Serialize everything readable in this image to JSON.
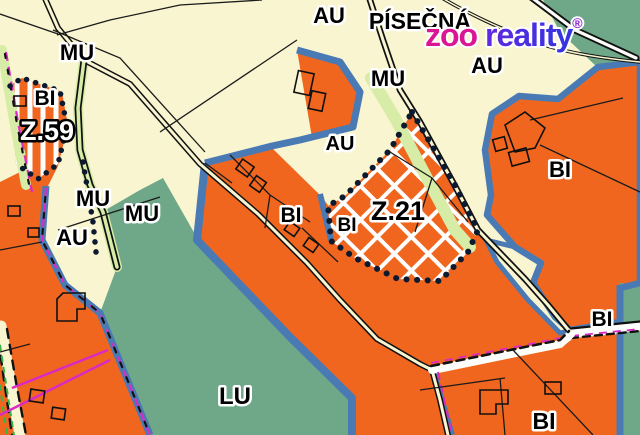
{
  "map": {
    "place_name": "PÍSEČNÁ",
    "zone_codes": {
      "mu": "MU",
      "au": "AU",
      "bi": "BI",
      "lu": "LU"
    },
    "site_codes": {
      "z59": "Z.59",
      "z21": "Z.21"
    }
  },
  "logo": {
    "zoo": "zoo ",
    "reality": "reality",
    "registered": "®"
  },
  "colors": {
    "cream": "#f8f5d0",
    "orange": "#f1661f",
    "green": "#6ea889",
    "verge": "#d7eca6",
    "blue": "#4a7ab4",
    "dots": "#0c1a30",
    "magenta": "#d92bc4",
    "roadgreen": "#35b44a",
    "logoZoo": "#db1695",
    "logoReg": "#8d1bd3"
  }
}
